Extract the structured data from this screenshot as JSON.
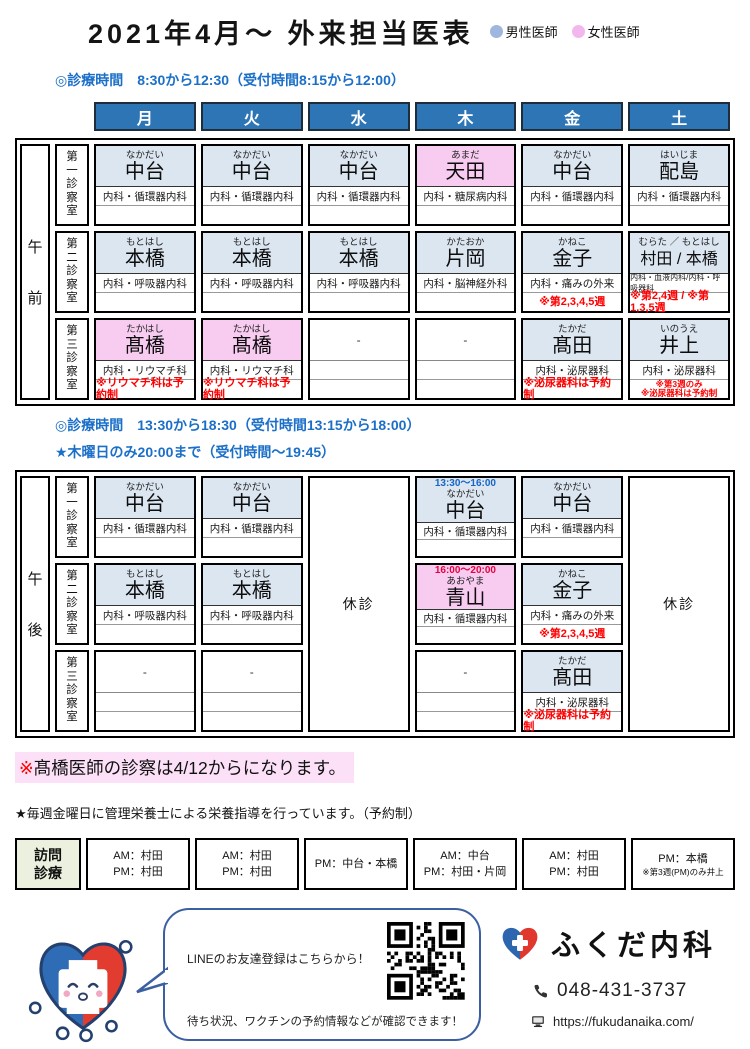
{
  "title": "2021年4月～ 外来担当医表",
  "legend": {
    "male": {
      "label": "男性医師",
      "color": "#9FB6DE"
    },
    "female": {
      "label": "女性医師",
      "color": "#F2B8EE"
    }
  },
  "days": [
    "月",
    "火",
    "水",
    "木",
    "金",
    "土"
  ],
  "rooms": [
    "第一診察室",
    "第二診察室",
    "第三診察室"
  ],
  "marks": {
    "empty": "-"
  },
  "colors": {
    "header_blue": "#2E75B6",
    "cell_blue": "#DCE6F1",
    "cell_pink": "#F8CCF1",
    "note_red": "#FF0000",
    "section_blue": "#1B6FC8",
    "visit_green": "#EBF1DE",
    "highlight_pink": "#FBE0F7"
  },
  "morning": {
    "session": "午前",
    "hours_line1": "◎診療時間　8:30から12:30（受付時間8:15から12:00）",
    "columns": [
      {
        "day": "月",
        "cells": [
          {
            "furigana": "なかだい",
            "name": "中台",
            "dept": "内科・循環器内科",
            "bg": "blue"
          },
          {
            "furigana": "もとはし",
            "name": "本橋",
            "dept": "内科・呼吸器内科",
            "bg": "blue"
          },
          {
            "furigana": "たかはし",
            "name": "髙橋",
            "dept": "内科・リウマチ科",
            "bg": "pink",
            "notes": [
              "※リウマチ科は予約制"
            ]
          }
        ]
      },
      {
        "day": "火",
        "cells": [
          {
            "furigana": "なかだい",
            "name": "中台",
            "dept": "内科・循環器内科",
            "bg": "blue"
          },
          {
            "furigana": "もとはし",
            "name": "本橋",
            "dept": "内科・呼吸器内科",
            "bg": "blue"
          },
          {
            "furigana": "たかはし",
            "name": "髙橋",
            "dept": "内科・リウマチ科",
            "bg": "pink",
            "notes": [
              "※リウマチ科は予約制"
            ]
          }
        ]
      },
      {
        "day": "水",
        "cells": [
          {
            "furigana": "なかだい",
            "name": "中台",
            "dept": "内科・循環器内科",
            "bg": "blue"
          },
          {
            "furigana": "もとはし",
            "name": "本橋",
            "dept": "内科・呼吸器内科",
            "bg": "blue"
          },
          {
            "empty": true
          }
        ]
      },
      {
        "day": "木",
        "cells": [
          {
            "furigana": "あまだ",
            "name": "天田",
            "dept": "内科・糖尿病内科",
            "bg": "pink"
          },
          {
            "furigana": "かたおか",
            "name": "片岡",
            "dept": "内科・脳神経外科",
            "bg": "blue"
          },
          {
            "empty": true
          }
        ]
      },
      {
        "day": "金",
        "cells": [
          {
            "furigana": "なかだい",
            "name": "中台",
            "dept": "内科・循環器内科",
            "bg": "blue"
          },
          {
            "furigana": "かねこ",
            "name": "金子",
            "dept": "内科・痛みの外来",
            "bg": "blue",
            "notes": [
              "※第2,3,4,5週"
            ]
          },
          {
            "furigana": "たかだ",
            "name": "髙田",
            "dept": "内科・泌尿器科",
            "bg": "blue",
            "notes": [
              "※泌尿器科は予約制"
            ]
          }
        ]
      },
      {
        "day": "土",
        "cells": [
          {
            "furigana": "はいじま",
            "name": "配島",
            "dept": "内科・循環器内科",
            "bg": "blue"
          },
          {
            "furigana": "むらた ／ もとはし",
            "name": "村田 / 本橋",
            "dept": "内科・血液内科/内科・呼吸器科",
            "bg": "blue",
            "small_dept": true,
            "small_name": true,
            "notes": [
              "※第2,4週 / ※第1,3,5週"
            ]
          },
          {
            "furigana": "いのうえ",
            "name": "井上",
            "dept": "内科・泌尿器科",
            "bg": "blue",
            "notes": [
              "※第3週のみ",
              "※泌尿器科は予約制"
            ]
          }
        ]
      }
    ]
  },
  "afternoon": {
    "session": "午後",
    "hours_line1": "◎診療時間　13:30から18:30（受付時間13:15から18:00）",
    "hours_line2": "★木曜日のみ20:00まで（受付時間～19:45）",
    "columns": [
      {
        "day": "月",
        "cells": [
          {
            "furigana": "なかだい",
            "name": "中台",
            "dept": "内科・循環器内科",
            "bg": "blue"
          },
          {
            "furigana": "もとはし",
            "name": "本橋",
            "dept": "内科・呼吸器内科",
            "bg": "blue"
          },
          {
            "empty": true
          }
        ]
      },
      {
        "day": "火",
        "cells": [
          {
            "furigana": "なかだい",
            "name": "中台",
            "dept": "内科・循環器内科",
            "bg": "blue"
          },
          {
            "furigana": "もとはし",
            "name": "本橋",
            "dept": "内科・呼吸器内科",
            "bg": "blue"
          },
          {
            "empty": true
          }
        ]
      },
      {
        "day": "水",
        "closed": "休診"
      },
      {
        "day": "木",
        "cells": [
          {
            "time": "13:30～16:00",
            "time_color": "#1565C6",
            "furigana": "なかだい",
            "name": "中台",
            "dept": "内科・循環器内科",
            "bg": "blue"
          },
          {
            "time": "16:00～20:00",
            "time_color": "#E8003D",
            "furigana": "あおやま",
            "name": "青山",
            "dept": "内科・循環器内科",
            "bg": "pink"
          },
          {
            "empty": true
          }
        ]
      },
      {
        "day": "金",
        "cells": [
          {
            "furigana": "なかだい",
            "name": "中台",
            "dept": "内科・循環器内科",
            "bg": "blue"
          },
          {
            "furigana": "かねこ",
            "name": "金子",
            "dept": "内科・痛みの外来",
            "bg": "blue",
            "notes": [
              "※第2,3,4,5週"
            ]
          },
          {
            "furigana": "たかだ",
            "name": "髙田",
            "dept": "内科・泌尿器科",
            "bg": "blue",
            "notes": [
              "※泌尿器科は予約制"
            ]
          }
        ]
      },
      {
        "day": "土",
        "closed": "休診"
      }
    ]
  },
  "notices": {
    "highlight": {
      "mark": "※",
      "text": "髙橋医師の診察は4/12からになります。"
    },
    "star": "★毎週金曜日に管理栄養士による栄養指導を行っています。（予約制）"
  },
  "visiting": {
    "label_line1": "訪問",
    "label_line2": "診療",
    "cells": [
      {
        "lines": [
          "AM：村田",
          "PM：村田"
        ]
      },
      {
        "lines": [
          "AM：村田",
          "PM：村田"
        ]
      },
      {
        "lines": [
          "PM：中台・本橋"
        ]
      },
      {
        "lines": [
          "AM：中台",
          "PM：村田・片岡"
        ]
      },
      {
        "lines": [
          "AM：村田",
          "PM：村田"
        ]
      },
      {
        "lines": [
          "PM：本橋",
          "※第3週(PM)のみ井上"
        ],
        "small_last": true
      }
    ]
  },
  "footer": {
    "bubble": {
      "line1": "LINEのお友達登録はこちらから！",
      "line2": "待ち状況、ワクチンの予約情報などが確認できます！"
    },
    "clinic": {
      "name": "ふくだ内科",
      "phone": "048-431-3737",
      "url": "https://fukudanaika.com/"
    }
  }
}
